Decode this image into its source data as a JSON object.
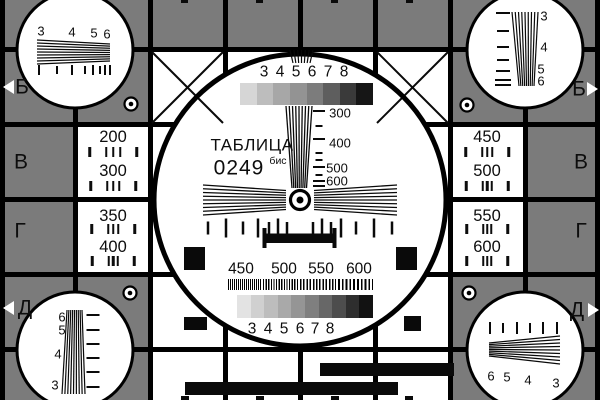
{
  "colors": {
    "background": "#7b7b7b",
    "grid_line": "#000000",
    "card_white": "#ffffff",
    "ink": "#0d0d0d"
  },
  "title": {
    "name": "ТАБЛИЦА",
    "code": "0249",
    "suffix": "бис"
  },
  "side_letters": {
    "left": [
      "Б",
      "В",
      "Г",
      "Д"
    ],
    "right": [
      "Б",
      "В",
      "Г",
      "Д"
    ]
  },
  "grayscale_top": {
    "labels": [
      "3",
      "4",
      "5",
      "6",
      "7",
      "8"
    ],
    "colors": [
      "#d6d6d6",
      "#bdbdbd",
      "#a7a7a7",
      "#939393",
      "#7c7c7c",
      "#5e5e5e",
      "#3a3a3a",
      "#161616"
    ]
  },
  "grayscale_bottom": {
    "labels": [
      "3",
      "4",
      "5",
      "6",
      "7",
      "8"
    ],
    "colors": [
      "#e3e3e3",
      "#d0d0d0",
      "#bdbdbd",
      "#a9a9a9",
      "#959595",
      "#7f7f7f",
      "#676767",
      "#4d4d4d",
      "#2e2e2e",
      "#121212"
    ]
  },
  "wedge_scale": [
    "300",
    "400",
    "500",
    "600"
  ],
  "burst_labels": [
    "450",
    "500",
    "550",
    "600"
  ],
  "freq_boxes": {
    "left": [
      "200",
      "300",
      "350",
      "400"
    ],
    "right": [
      "450",
      "500",
      "550",
      "600"
    ]
  },
  "corner_labels": {
    "top_left": [
      "3",
      "4",
      "5",
      "6"
    ],
    "top_right": [
      "3",
      "4",
      "5",
      "6"
    ],
    "bottom_left": [
      "6",
      "5",
      "4",
      "3"
    ],
    "bottom_right": [
      "6",
      "5",
      "4",
      "3"
    ]
  }
}
